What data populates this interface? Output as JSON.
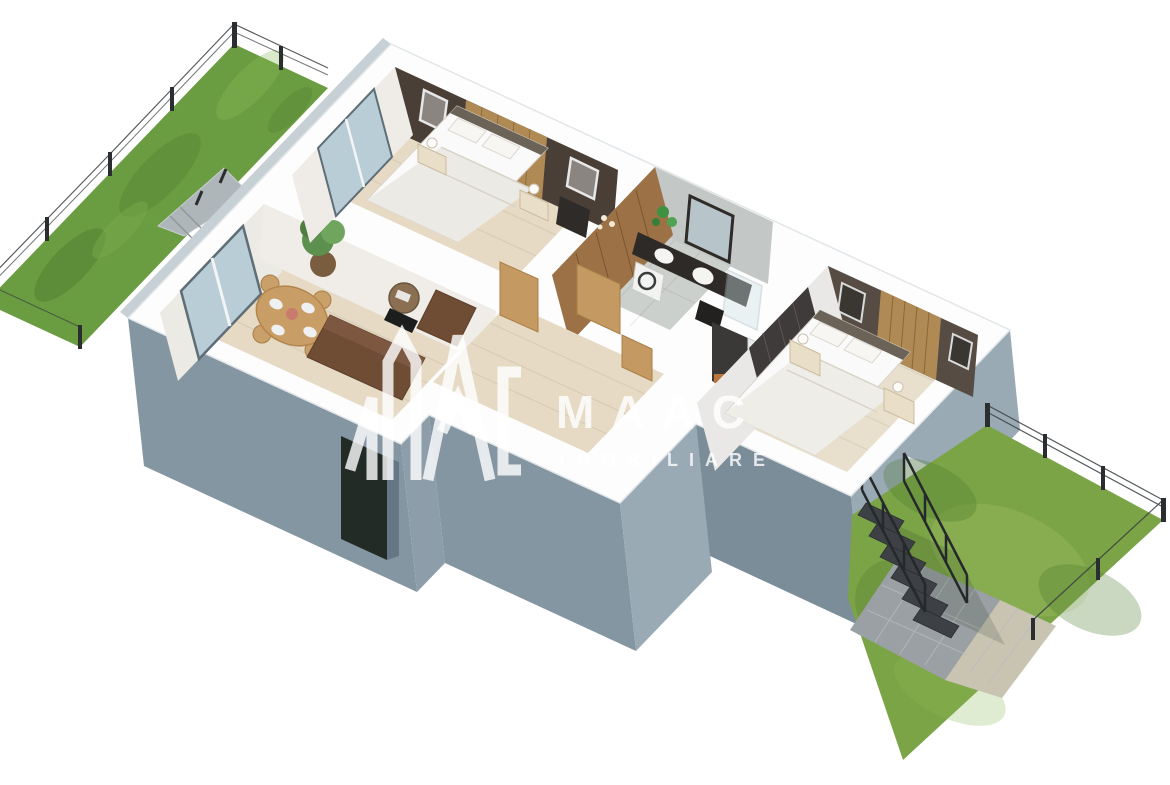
{
  "watermark": {
    "brand": "MAAC",
    "tagline": "IMOBILIARE",
    "color": "rgba(255,255,255,0.8)"
  },
  "palette": {
    "background": "#ffffff",
    "wall_top": "#fdfdfd",
    "wall_edge": "#e2e6e9",
    "facade": "#8496a2",
    "facade_dark": "#76era2",
    "facade_shaded": "#7b8d99",
    "facade_light": "#9aaab5",
    "facade_side": "#c6d0d5",
    "grass": "#6a9c41",
    "grass_dark": "#4e7a2d",
    "grass_light": "#8cbd5c",
    "grass_se": "#7ba446",
    "floor_wood": "#e6dac5",
    "floor_wood_light": "#e8dfcd",
    "floor_tile": "#ccd0cd",
    "accent_wall_brown": "#4a3f36",
    "accent_wall_gray": "#564c43",
    "wood_panel": "#b08a54",
    "door_wood": "#c49a62",
    "sofa_brown": "#6f4c34",
    "dining_wood": "#c99e66",
    "vanity_dark": "#2e2a27",
    "glass_blue": "#b9cdd6",
    "stairs_dark": "#3d4145",
    "fence_dark": "#2b2e30",
    "patio_gray": "#9aa0a3",
    "patio_beige": "#c9c3b2",
    "entry_door": "#222b26",
    "bed_white": "#fbfafa",
    "plant_green": "#5d8f4e"
  }
}
